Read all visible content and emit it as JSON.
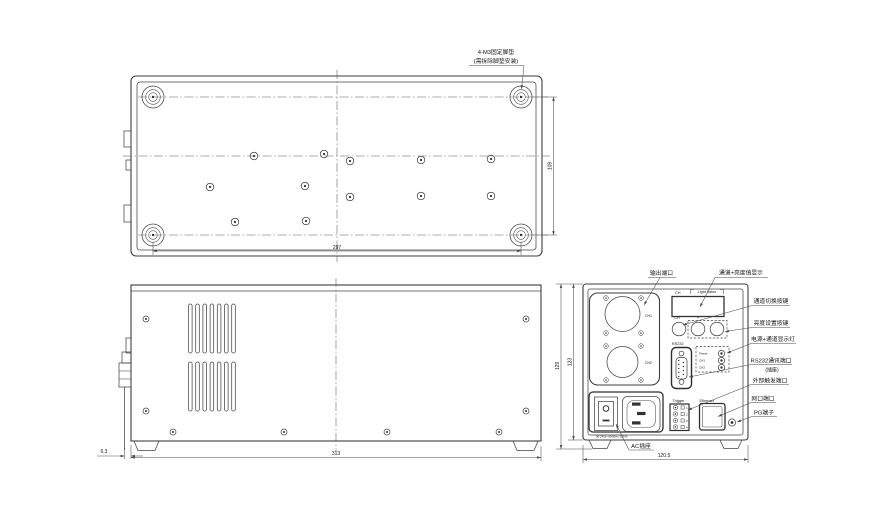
{
  "drawing": {
    "foot_note_line1": "4-M3固定脚垫",
    "foot_note_line2": "(需拆除脚垫安装)",
    "dims": {
      "top_width": "297",
      "top_height": "109",
      "side_width": "313",
      "side_offset": "6.3",
      "rear_width": "120.5",
      "rear_height_outer": "129",
      "rear_height_inner": "123"
    },
    "rear_panel": {
      "display_ch": "CH",
      "display_value": "Light Value",
      "btn_ch": "CH",
      "btn_plus": "+",
      "btn_minus": "-",
      "rs232": "RS232",
      "led_power": "Power",
      "led_ch1": "CH1",
      "led_ch2": "CH2",
      "out_ch1": "CH1",
      "out_ch2": "CH2",
      "trigger": "Trigger",
      "pin1": "1",
      "pin2": "2",
      "pin3": "3",
      "pin4": "4",
      "ethernet": "Ethernet",
      "rating": "90-240V~50/60Hz 300VA"
    },
    "callouts": {
      "output_port": "输出端口",
      "display": "通道+亮度值显示",
      "channel_switch": "通道切换按键",
      "brightness_set": "亮度设置按键",
      "power_leds": "电源+通道显示灯",
      "rs232_port": "RS232通讯端口",
      "rs232_sub": "(插座)",
      "trigger_port": "外部触发端口",
      "lan_port": "网口端口",
      "pg_terminal": "PG端子",
      "ac_socket": "AC插座"
    }
  }
}
